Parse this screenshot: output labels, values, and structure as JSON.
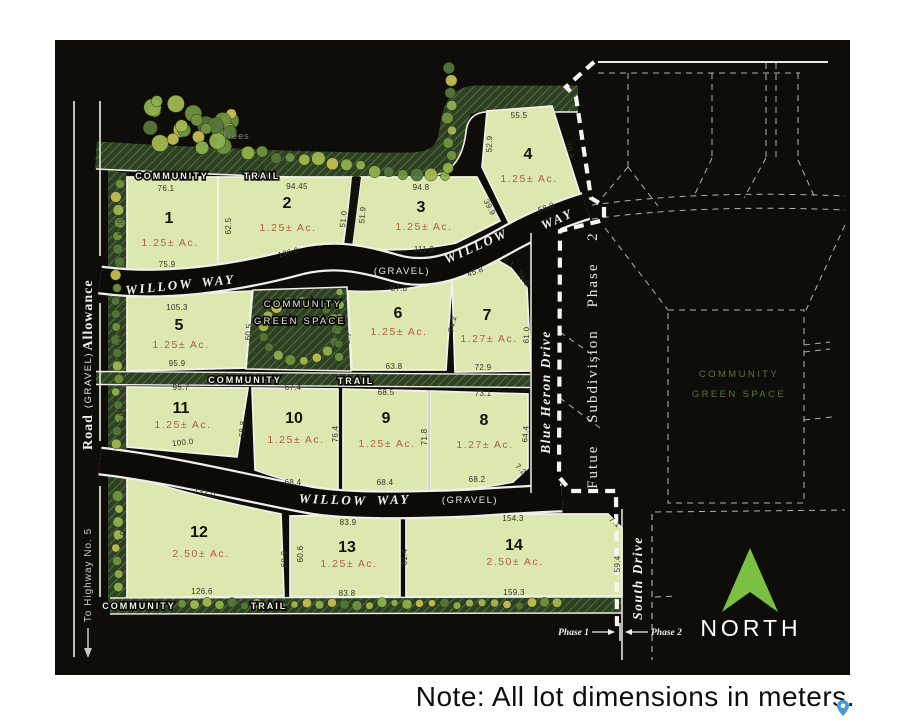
{
  "page": {
    "note": "Note: All lot dimensions in meters."
  },
  "map": {
    "north_label": "NORTH",
    "trees_label": "Trees",
    "colors": {
      "lot_fill": "#dde8b0",
      "map_bg": "#0f0d0a",
      "north_arrow_green": "#7ac143",
      "area_text": "#b05f3e",
      "pin_blue": "#4a97d2"
    },
    "left_road": {
      "name_word1": "Road",
      "name_word2": "Allowance",
      "surface": "(GRAVEL)",
      "direction": "To Highway No. 5"
    },
    "willow_upper": {
      "name1": "WILLOW",
      "name2": "WAY",
      "surface": "(GRAVEL)"
    },
    "willow_lower": {
      "name1": "WILLOW",
      "name2": "WAY",
      "surface": "(GRAVEL)"
    },
    "blue_heron": "Blue Heron Drive",
    "south_drive": "South Drive",
    "future_label": "Futue Subdivision Phase 2",
    "phase_marker": {
      "left": "Phase 1",
      "right": "Phase 2"
    },
    "trail": {
      "word1": "COMMUNITY",
      "word2": "TRAIL"
    },
    "green_space": {
      "line1": "COMMUNITY",
      "line2": "GREEN SPACE"
    }
  },
  "lots": [
    {
      "number": "1",
      "area": "1.25± Ac.",
      "dims": {
        "top": "76.1",
        "left": "67.0",
        "bottom": "75.9"
      }
    },
    {
      "number": "2",
      "area": "1.25± Ac.",
      "dims": {
        "top": "94.45",
        "left": "62.5",
        "right": "51.0",
        "bottom": "106.0"
      }
    },
    {
      "number": "3",
      "area": "1.25± Ac.",
      "dims": {
        "top": "94.8",
        "left": "51.9",
        "right": "39.9",
        "bottom": "111.9"
      }
    },
    {
      "number": "4",
      "area": "1.25± Ac.",
      "dims": {
        "top": "55.5",
        "left": "52.9",
        "right": "70.8",
        "bottom": "58.8"
      }
    },
    {
      "number": "5",
      "area": "1.25± Ac.",
      "dims": {
        "top": "105.3",
        "left": "48.0",
        "right": "60.5",
        "bottom": "95.9"
      }
    },
    {
      "number": "6",
      "area": "1.25± Ac.",
      "dims": {
        "top": "87.8",
        "left": "72.7",
        "right": "74.2",
        "bottom": "63.8"
      }
    },
    {
      "number": "7",
      "area": "1.27± Ac.",
      "dims": {
        "top": "45.8",
        "corner_a": "7.1",
        "corner_b": "25.0",
        "right": "61.0",
        "bottom": "72.9"
      }
    },
    {
      "number": "8",
      "area": "1.27± Ac.",
      "dims": {
        "top": "73.1",
        "right": "64.4",
        "bottom": "68.2",
        "corner": "7.2"
      }
    },
    {
      "number": "9",
      "area": "1.25± Ac.",
      "dims": {
        "top": "68.5",
        "right": "71.8",
        "bottom": "68.4"
      }
    },
    {
      "number": "10",
      "area": "1.25± Ac.",
      "dims": {
        "top": "67.4",
        "right": "76.4",
        "bottom": "68.4"
      }
    },
    {
      "number": "11",
      "area": "1.25± Ac.",
      "dims": {
        "top": "95.7",
        "left": "46.0",
        "right": "68.8",
        "bottom": "100.0"
      }
    },
    {
      "number": "12",
      "area": "2.50± Ac.",
      "dims": {
        "top": "132.0",
        "left": "97.0",
        "right": "60.9",
        "bottom": "126.6"
      }
    },
    {
      "number": "13",
      "area": "1.25± Ac.",
      "dims": {
        "top": "83.9",
        "left": "60.6",
        "right": "61.4",
        "bottom": "83.8"
      }
    },
    {
      "number": "14",
      "area": "2.50± Ac.",
      "dims": {
        "top": "154.3",
        "corner": "7.1",
        "right": "59.4",
        "bottom": "159.3"
      }
    }
  ]
}
